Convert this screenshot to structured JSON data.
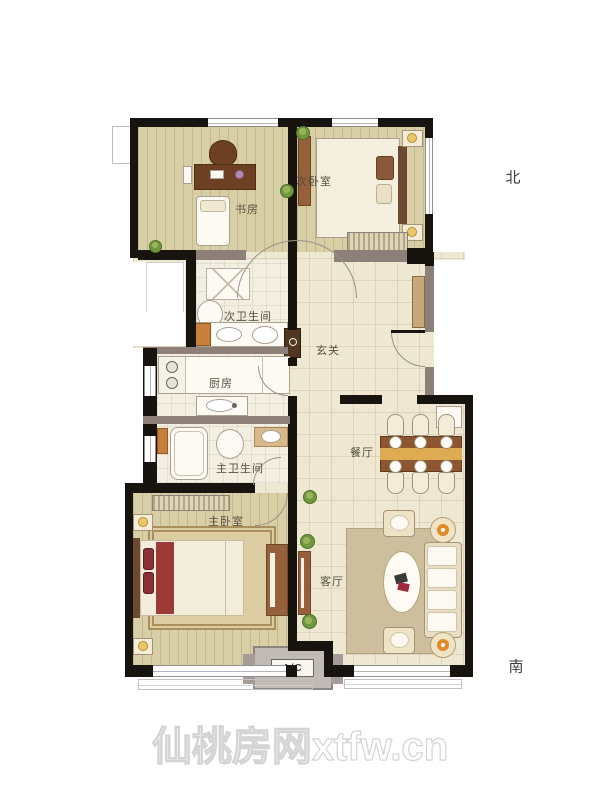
{
  "compass": {
    "north": "北",
    "south": "南"
  },
  "rooms": {
    "study": "书房",
    "bedroom2": "次卧室",
    "bath2": "次卫生间",
    "kitchen": "厨房",
    "foyer": "玄关",
    "bath1": "主卫生间",
    "bedroom1": "主卧室",
    "dining": "餐厅",
    "living": "客厅"
  },
  "ac": {
    "label": "A/C"
  },
  "watermark": {
    "text": "仙桃房网xtfw.cn"
  },
  "colors": {
    "exterior_wall": "#17130f",
    "interior_wall": "#8d8078",
    "wood_floor": "#d9cfa6",
    "tile_floor": "#eee7d1",
    "bath_floor": "#f2eee1",
    "furniture_brown": "#96603a",
    "dining_table": "#8d5630",
    "table_runner": "#dcab52",
    "rug": "#cdbf9d",
    "accent_red": "#9c3138",
    "plant_green": "#6f9840",
    "ac_platform": "#c2bab5",
    "watermark_gray": "#d4d4d4"
  }
}
